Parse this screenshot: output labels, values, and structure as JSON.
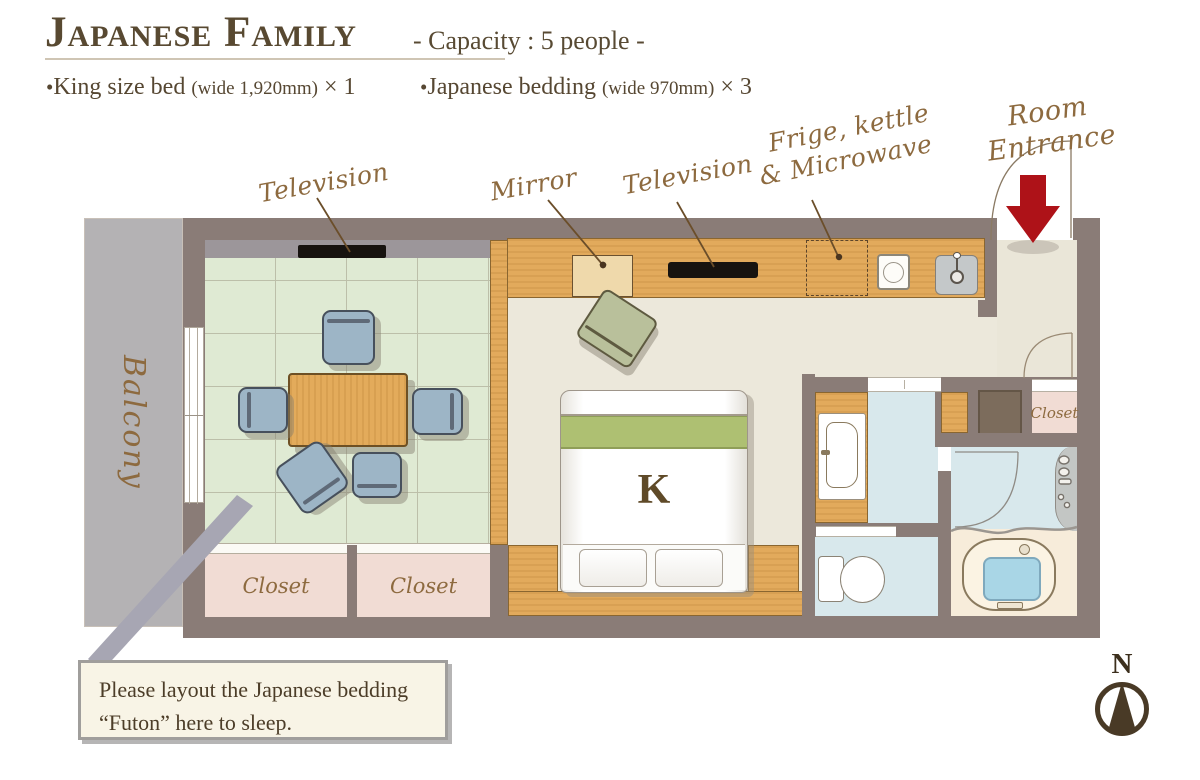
{
  "header": {
    "title": "Japanese Family",
    "capacity": "- Capacity : 5 people -",
    "bullets": [
      {
        "bullet": "•",
        "name": "King size bed ",
        "detail": "(wide 1,920mm)",
        "count": " × 1"
      },
      {
        "bullet": "•",
        "name": "Japanese bedding ",
        "detail": "(wide 970mm)",
        "count": " × 3"
      }
    ]
  },
  "annotations": {
    "television_left": "Television",
    "mirror": "Mirror",
    "television_right": "Television",
    "fridge_line1": "Frige, kettle",
    "fridge_line2": "& Microwave",
    "entrance_line1": "Room",
    "entrance_line2": "Entrance"
  },
  "rooms": {
    "balcony": "Balcony",
    "closet_left": "Closet",
    "closet_right": "Closet",
    "closet_entrance": "Closet",
    "bed_mark": "K"
  },
  "note": {
    "line1": "Please layout the Japanese bedding",
    "line2": "“Futon” here to sleep."
  },
  "compass": {
    "north": "N"
  },
  "colors": {
    "wall": "#8a7c77",
    "tatami_green": "#dfead3",
    "wood": "#e2aa5c",
    "floor_cream": "#ece8db",
    "balcony_gray": "#b4b2b4",
    "closet_pink": "#f1dcd4",
    "wet_area_blue": "#d8e8ec",
    "bath_floor": "#f7ecda",
    "tub_water": "#a9d6e6",
    "bed_green_band": "#aec072",
    "arrow_red": "#ae1218",
    "label_brown": "#8d6a3f",
    "text_brown": "#564732"
  }
}
